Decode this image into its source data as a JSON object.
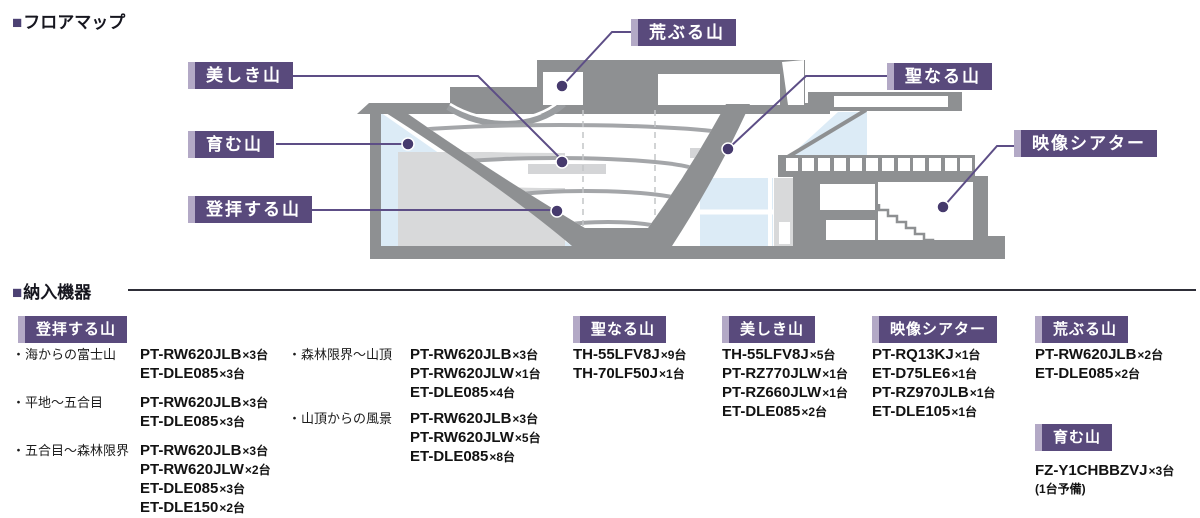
{
  "colors": {
    "accent": "#594a7c",
    "accent_light": "#b3a9c6",
    "leader_line": "#5d4e86",
    "dot": "#463a6d",
    "building_gray": "#8e9092",
    "block_gray": "#d8d9da",
    "glass_blue": "#dcebf6"
  },
  "floor_map": {
    "marker": "■",
    "title": "フロアマップ",
    "callouts": [
      {
        "label": "美しき山"
      },
      {
        "label": "育む山"
      },
      {
        "label": "登拝する山"
      },
      {
        "label": "荒ぶる山"
      },
      {
        "label": "聖なる山"
      },
      {
        "label": "映像シアター"
      }
    ]
  },
  "equipment": {
    "marker": "■",
    "title": "納入機器",
    "groups": [
      {
        "name": "登拝する山",
        "subareas": [
          {
            "name": "・海からの富士山",
            "items": [
              {
                "model": "PT-RW620JLB",
                "qty": "×3台"
              },
              {
                "model": "ET-DLE085",
                "qty": "×3台"
              }
            ]
          },
          {
            "name": "・平地～五合目",
            "items": [
              {
                "model": "PT-RW620JLB",
                "qty": "×3台"
              },
              {
                "model": "ET-DLE085",
                "qty": "×3台"
              }
            ]
          },
          {
            "name": "・五合目～森林限界",
            "items": [
              {
                "model": "PT-RW620JLB",
                "qty": "×3台"
              },
              {
                "model": "PT-RW620JLW",
                "qty": "×2台"
              },
              {
                "model": "ET-DLE085",
                "qty": "×3台"
              },
              {
                "model": "ET-DLE150",
                "qty": "×2台"
              }
            ]
          },
          {
            "name": "・森林限界～山頂",
            "items": [
              {
                "model": "PT-RW620JLB",
                "qty": "×3台"
              },
              {
                "model": "PT-RW620JLW",
                "qty": "×1台"
              },
              {
                "model": "ET-DLE085",
                "qty": "×4台"
              }
            ]
          },
          {
            "name": "・山頂からの風景",
            "items": [
              {
                "model": "PT-RW620JLB",
                "qty": "×3台"
              },
              {
                "model": "PT-RW620JLW",
                "qty": "×5台"
              },
              {
                "model": "ET-DLE085",
                "qty": "×8台"
              }
            ]
          }
        ]
      },
      {
        "name": "聖なる山",
        "items": [
          {
            "model": "TH-55LFV8J",
            "qty": "×9台"
          },
          {
            "model": "TH-70LF50J",
            "qty": "×1台"
          }
        ]
      },
      {
        "name": "美しき山",
        "items": [
          {
            "model": "TH-55LFV8J",
            "qty": "×5台"
          },
          {
            "model": "PT-RZ770JLW",
            "qty": "×1台"
          },
          {
            "model": "PT-RZ660JLW",
            "qty": "×1台"
          },
          {
            "model": "ET-DLE085",
            "qty": "×2台"
          }
        ]
      },
      {
        "name": "映像シアター",
        "items": [
          {
            "model": "PT-RQ13KJ",
            "qty": "×1台"
          },
          {
            "model": "ET-D75LE6",
            "qty": "×1台"
          },
          {
            "model": "PT-RZ970JLB",
            "qty": "×1台"
          },
          {
            "model": "ET-DLE105",
            "qty": "×1台"
          }
        ]
      },
      {
        "name": "荒ぶる山",
        "items": [
          {
            "model": "PT-RW620JLB",
            "qty": "×2台"
          },
          {
            "model": "ET-DLE085",
            "qty": "×2台"
          }
        ]
      },
      {
        "name": "育む山",
        "items": [
          {
            "model": "FZ-Y1CHBBZVJ",
            "qty": "×3台"
          }
        ],
        "note": "(1台予備)"
      }
    ]
  }
}
